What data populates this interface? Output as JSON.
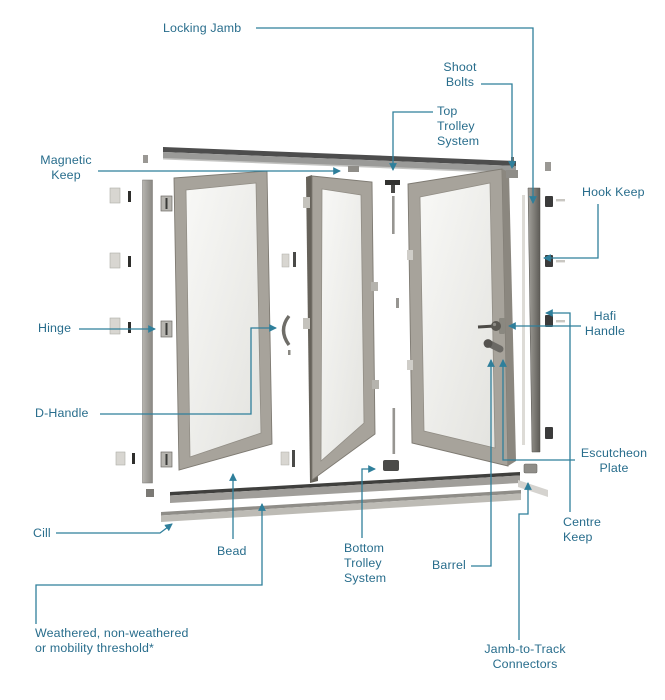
{
  "diagram": {
    "subject": "bifold-door-exploded-parts-diagram",
    "colors": {
      "label_text": "#286d8c",
      "callout_line": "#2f7f9b",
      "door_frame": "#a7a39b",
      "door_edge_dark": "#66625a",
      "glass": "#efefec",
      "track_dark": "#4d4d4d",
      "metal_gray": "#8f8d88",
      "hardware_dark": "#3b3b3b",
      "background": "#ffffff"
    }
  },
  "labels": {
    "locking_jamb": {
      "text": "Locking Jamb"
    },
    "shoot_bolts": {
      "text": "Shoot\nBolts"
    },
    "top_trolley": {
      "text": "Top\nTrolley\nSystem"
    },
    "magnetic_keep": {
      "text": "Magnetic\nKeep"
    },
    "hook_keep": {
      "text": "Hook Keep"
    },
    "hinge": {
      "text": "Hinge"
    },
    "hafi_handle": {
      "text": "Hafi\nHandle"
    },
    "d_handle": {
      "text": "D-Handle"
    },
    "escutcheon_plate": {
      "text": "Escutcheon\nPlate"
    },
    "centre_keep": {
      "text": "Centre\nKeep"
    },
    "cill": {
      "text": "Cill"
    },
    "bead": {
      "text": "Bead"
    },
    "bottom_trolley": {
      "text": "Bottom\nTrolley\nSystem"
    },
    "barrel": {
      "text": "Barrel"
    },
    "threshold": {
      "text": "Weathered, non-weathered\nor mobility threshold*"
    },
    "jamb_to_track": {
      "text": "Jamb-to-Track\nConnectors"
    }
  }
}
